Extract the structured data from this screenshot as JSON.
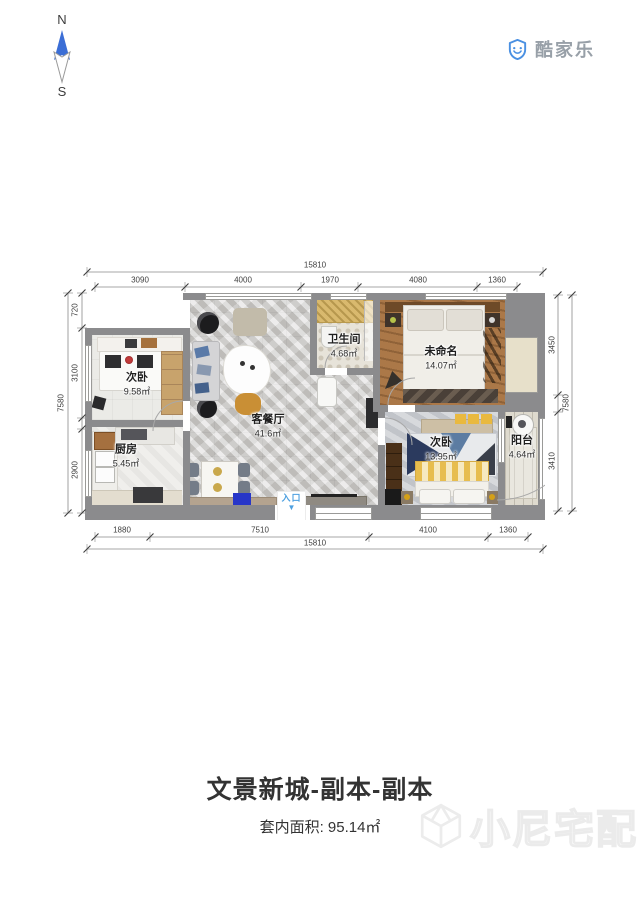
{
  "compass": {
    "north": "N",
    "south": "S"
  },
  "brand": {
    "name": "酷家乐"
  },
  "plan": {
    "rooms": [
      {
        "id": "bedroom-topleft",
        "name": "次卧",
        "area": "9.58㎡"
      },
      {
        "id": "kitchen",
        "name": "厨房",
        "area": "5.45㎡"
      },
      {
        "id": "living-dining",
        "name": "客餐厅",
        "area": "41.6㎡"
      },
      {
        "id": "bathroom",
        "name": "卫生间",
        "area": "4.68㎡"
      },
      {
        "id": "master-bedroom",
        "name": "未命名",
        "area": "14.07㎡"
      },
      {
        "id": "bedroom-second",
        "name": "次卧",
        "area": "13.95㎡"
      },
      {
        "id": "balcony",
        "name": "阳台",
        "area": "4.64㎡"
      }
    ],
    "entry": {
      "label": "入口",
      "arrow": "▼"
    },
    "dimensions": {
      "top": {
        "total": "15810",
        "segments": [
          "3090",
          "4000",
          "1970",
          "4080",
          "1360"
        ]
      },
      "bottom": {
        "total": "15810",
        "segments": [
          "1880",
          "7510",
          "4100",
          "1360"
        ]
      },
      "left": {
        "total": "7580",
        "segments": [
          "720",
          "3100",
          "2900"
        ]
      },
      "right": {
        "total": "7580",
        "segments": [
          "3450",
          "3410"
        ]
      }
    }
  },
  "footer": {
    "title": "文景新城-副本-副本",
    "area_text": "套内面积: 95.14㎡"
  },
  "watermark": {
    "text": "小尼宅配"
  },
  "colors": {
    "wall": "#8b8b8d",
    "brand_blue": "#4a90e2",
    "brand_gray": "#98a0a8",
    "entry_blue": "#4da0e0",
    "compass_blue": "#3b6ed6",
    "master_floor": "#ab7848",
    "living_floor": "#d7d6d4"
  }
}
